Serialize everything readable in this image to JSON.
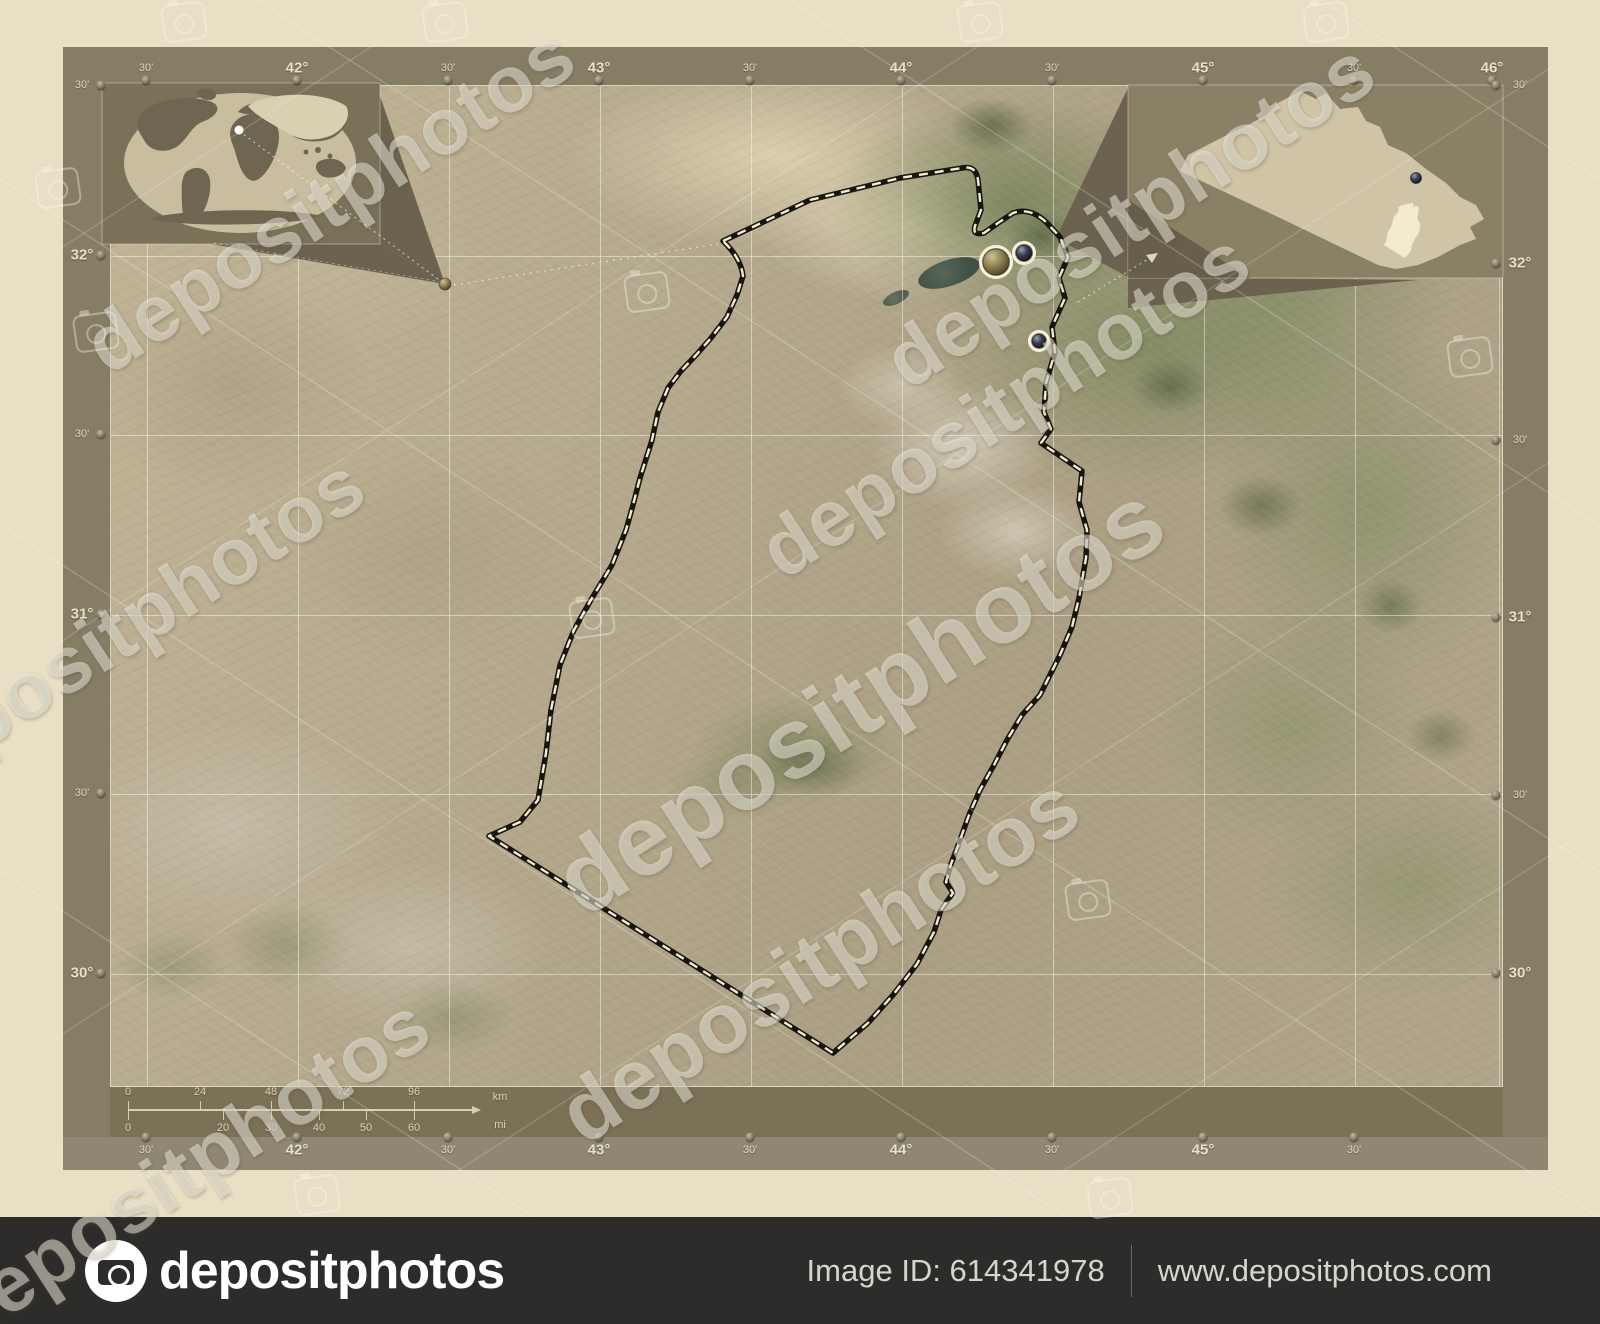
{
  "page": {
    "width": 1600,
    "height": 1324
  },
  "colors": {
    "page_bg": "#e8dfc4",
    "frame": "#867d65",
    "scale_band": "#7b7157",
    "label_strip": "#8f8772",
    "footer_bar": "#2d2c2a",
    "boundary_dark": "#17150f",
    "boundary_dash": "#f3ecd3",
    "inset_wedge": "#6b6350",
    "globe": "#c9bda0",
    "continent": "#6e6650",
    "iraq_fill": "#cfc4a6",
    "province_highlight": "#f3ead0"
  },
  "frame": {
    "top_labels": [
      {
        "t": "30'",
        "x": 146
      },
      {
        "t": "42°",
        "x": 297
      },
      {
        "t": "30'",
        "x": 448
      },
      {
        "t": "43°",
        "x": 599
      },
      {
        "t": "30'",
        "x": 750
      },
      {
        "t": "44°",
        "x": 901
      },
      {
        "t": "30'",
        "x": 1052
      },
      {
        "t": "45°",
        "x": 1203
      },
      {
        "t": "30'",
        "x": 1354
      },
      {
        "t": "46°",
        "x": 1492
      }
    ],
    "bottom_labels": [
      {
        "t": "30'",
        "x": 146
      },
      {
        "t": "42°",
        "x": 297
      },
      {
        "t": "30'",
        "x": 448
      },
      {
        "t": "43°",
        "x": 599
      },
      {
        "t": "30'",
        "x": 750
      },
      {
        "t": "44°",
        "x": 901
      },
      {
        "t": "30'",
        "x": 1052
      },
      {
        "t": "45°",
        "x": 1203
      },
      {
        "t": "30'",
        "x": 1354
      }
    ],
    "left_labels": [
      {
        "t": "30'",
        "y": 85
      },
      {
        "t": "32°",
        "y": 255
      },
      {
        "t": "30'",
        "y": 434
      },
      {
        "t": "31°",
        "y": 614
      },
      {
        "t": "30'",
        "y": 793
      },
      {
        "t": "30°",
        "y": 973
      }
    ],
    "right_labels": [
      {
        "t": "30'",
        "y": 85
      },
      {
        "t": "32°",
        "y": 263
      },
      {
        "t": "30'",
        "y": 440
      },
      {
        "t": "31°",
        "y": 617
      },
      {
        "t": "30'",
        "y": 795
      },
      {
        "t": "30°",
        "y": 973
      }
    ]
  },
  "map": {
    "lon_lines": [
      146,
      297,
      448,
      599,
      750,
      901,
      1052,
      1203,
      1354,
      1498
    ],
    "lat_lines": [
      255,
      434,
      614,
      793,
      973
    ],
    "cities": [
      {
        "x": 996,
        "y": 262,
        "r": 13,
        "kind": "capital"
      },
      {
        "x": 1024,
        "y": 253,
        "r": 8,
        "kind": "city"
      },
      {
        "x": 1039,
        "y": 341,
        "r": 7,
        "kind": "city"
      }
    ]
  },
  "region": {
    "outline_path": "M723 241 L810 200 L900 178 L962 168 Q976 165 978 180 L981 210 L975 226 Q972 236 984 233 L998 223 L1013 213 Q1030 207 1046 222 L1060 237 L1068 257 L1059 278 L1065 298 L1052 327 L1055 352 L1046 383 L1044 412 L1051 429 L1041 443 L1060 456 L1082 471 L1079 502 L1087 530 L1086 558 L1079 598 L1072 627 L1060 655 L1040 695 L1022 715 L1007 740 L994 765 L980 790 L969 815 L959 843 L951 864 L946 882 L953 893 L941 910 L934 932 L917 964 L893 995 L868 1023 L833 1053 L489 836 L520 822 L538 800 L546 753 L551 710 L560 665 L574 630 L592 598 L612 565 L626 530 L633 505 L640 478 L652 440 L658 412 L668 388 L681 371 L697 354 L711 338 L727 317 L737 295 L743 276 Q741 258 723 241 Z"
  },
  "scalebar": {
    "unit_top": "km",
    "unit_bottom": "mi",
    "axis_y": 1110,
    "x_start": 128,
    "arrow_tip": 472,
    "km_ticks": [
      {
        "t": "0",
        "x": 128
      },
      {
        "t": "24",
        "x": 200
      },
      {
        "t": "48",
        "x": 271
      },
      {
        "t": "72",
        "x": 343
      },
      {
        "t": "96",
        "x": 414
      }
    ],
    "mi_ticks": [
      {
        "t": "0",
        "x": 128
      },
      {
        "t": "20",
        "x": 223
      },
      {
        "t": "30",
        "x": 271
      },
      {
        "t": "40",
        "x": 319
      },
      {
        "t": "50",
        "x": 366
      },
      {
        "t": "60",
        "x": 414
      }
    ]
  },
  "watermark": {
    "text": "depositphotos",
    "instances": [
      {
        "x": 860,
        "y": 700,
        "size": 100
      },
      {
        "x": 1005,
        "y": 405,
        "size": 80
      },
      {
        "x": 330,
        "y": 200,
        "size": 80
      },
      {
        "x": 1130,
        "y": 215,
        "size": 80
      },
      {
        "x": 120,
        "y": 630,
        "size": 80
      },
      {
        "x": 185,
        "y": 1170,
        "size": 80
      },
      {
        "x": 820,
        "y": 960,
        "size": 85
      }
    ],
    "cameras": [
      {
        "x": 184,
        "y": 22
      },
      {
        "x": 445,
        "y": 22
      },
      {
        "x": 980,
        "y": 22
      },
      {
        "x": 1326,
        "y": 22
      },
      {
        "x": 58,
        "y": 188
      },
      {
        "x": 96,
        "y": 332
      },
      {
        "x": 1470,
        "y": 357
      },
      {
        "x": 647,
        "y": 292
      },
      {
        "x": 592,
        "y": 618
      },
      {
        "x": 1088,
        "y": 900
      },
      {
        "x": 317,
        "y": 1195
      },
      {
        "x": 1110,
        "y": 1198
      }
    ]
  },
  "footer": {
    "logo_text": "depositphotos",
    "image_id": "Image ID: 614341978",
    "website": "www.depositphotos.com"
  }
}
